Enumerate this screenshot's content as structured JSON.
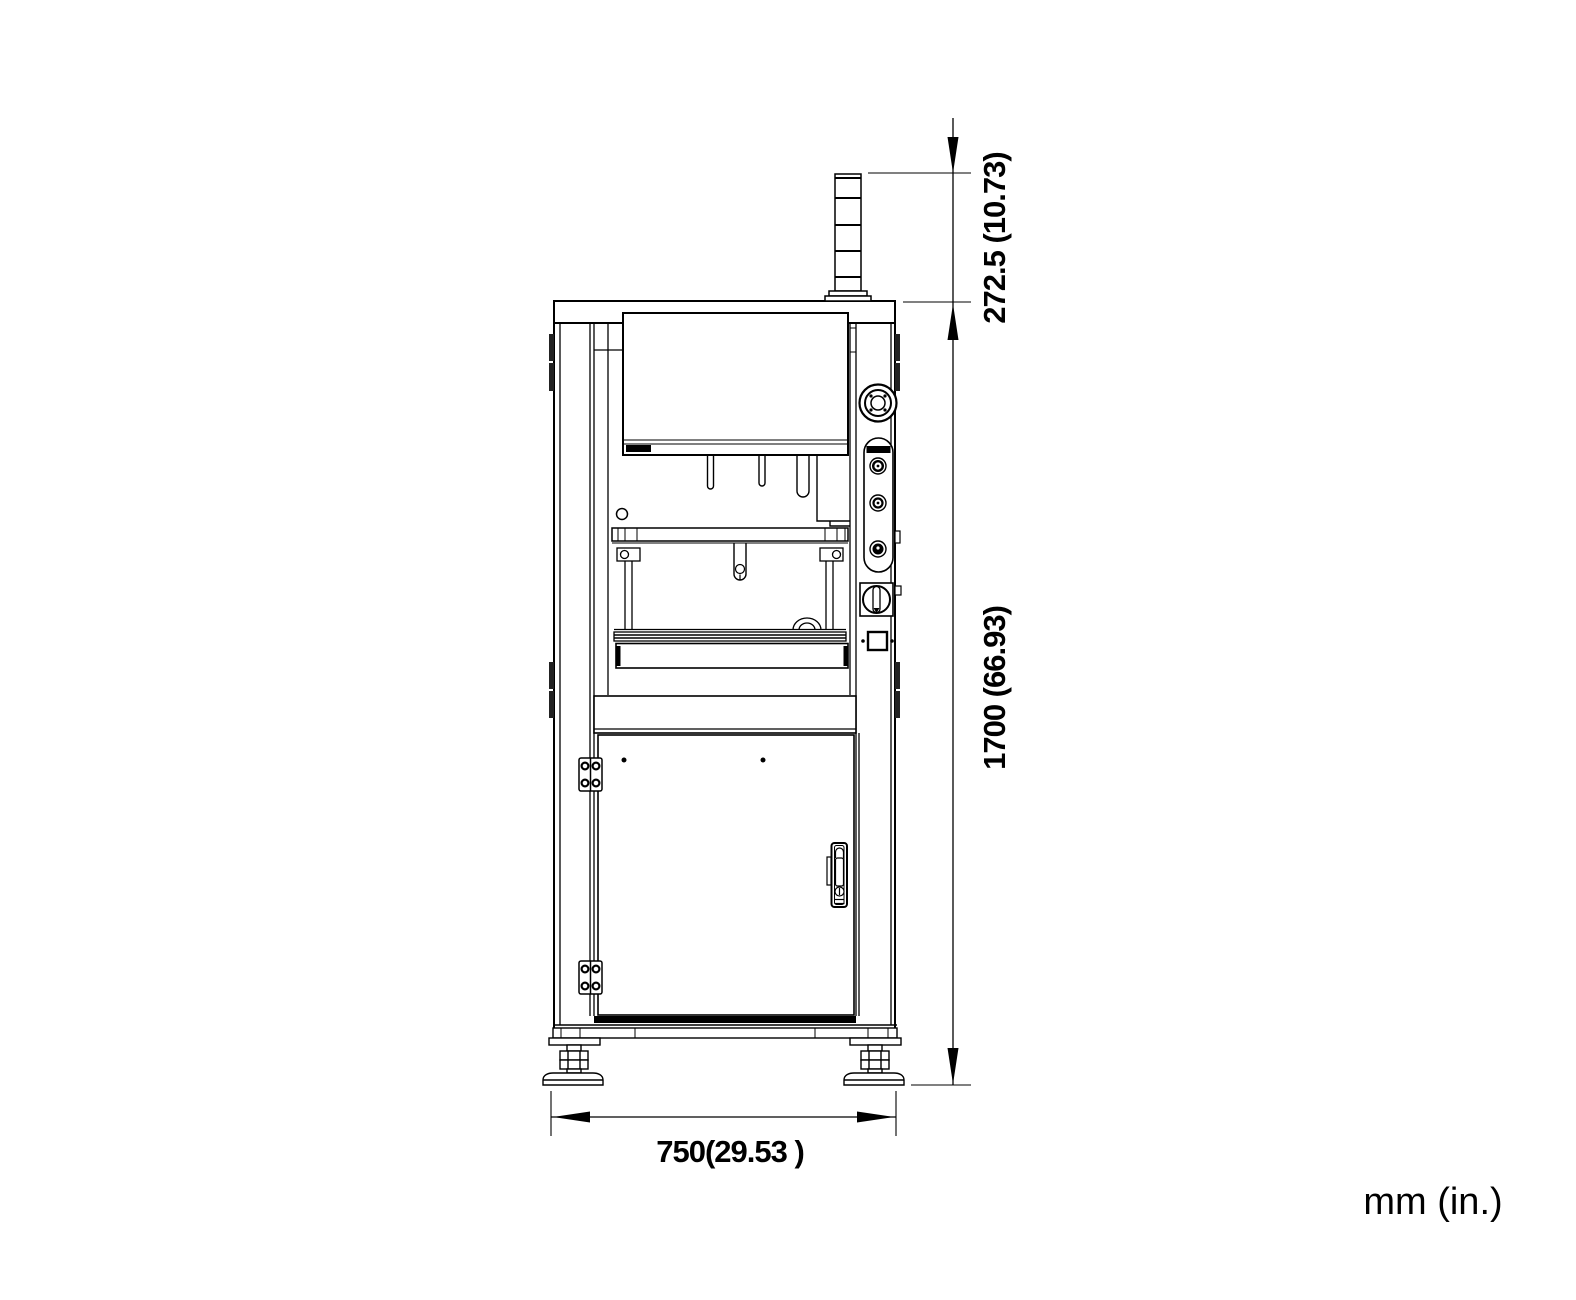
{
  "canvas": {
    "width": 1576,
    "height": 1300,
    "background": "#ffffff",
    "line_color": "#000000"
  },
  "drawing": {
    "type": "technical-dimension-drawing",
    "view": "machine front view",
    "units_label": "mm (in.)",
    "dimensions": {
      "signal_tower_height": {
        "label": "272.5 (10.73)",
        "mm": "272.5",
        "inches": "10.73",
        "orientation": "vertical"
      },
      "overall_height": {
        "label": "1700 (66.93)",
        "mm": "1700",
        "inches": "66.93",
        "orientation": "vertical"
      },
      "overall_width": {
        "label": "750(29.53 )",
        "mm": "750",
        "inches": "29.53",
        "orientation": "horizontal"
      }
    },
    "machine_parts": [
      "signal-tower",
      "top-plate",
      "upper-door-panel",
      "nameplate",
      "emergency-stop-button",
      "control-button-panel",
      "power-rotary-switch",
      "connector-port",
      "guide-pins",
      "press-beam",
      "press-tool",
      "work-posts",
      "work-table",
      "mid-frame-band",
      "lower-cabinet-door",
      "door-hinges",
      "door-handle",
      "base-frame",
      "leveling-feet"
    ]
  }
}
